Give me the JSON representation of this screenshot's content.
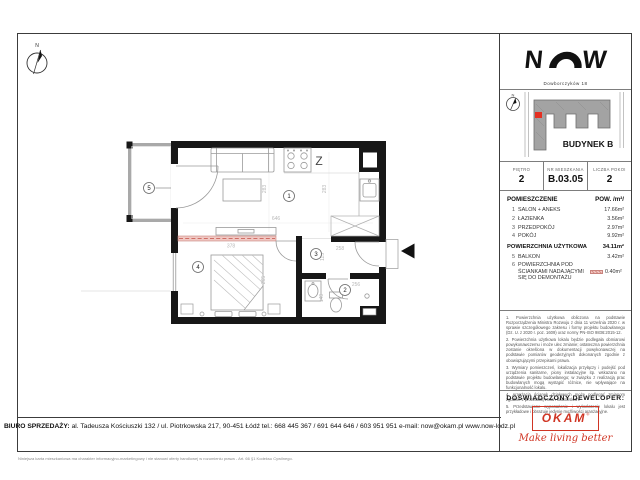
{
  "logo": {
    "letter_n": "N",
    "letter_w": "W",
    "subtitle": "Dowborczyków 18"
  },
  "sitemap": {
    "compass_n": "N",
    "building_label": "BUDYNEK B"
  },
  "unit_info": {
    "columns": [
      {
        "label": "PIĘTRO",
        "value": "2"
      },
      {
        "label": "NR MIESZKANIA",
        "value": "B.03.05"
      },
      {
        "label": "LICZBA POKOI",
        "value": "2"
      }
    ]
  },
  "rooms": {
    "header_name": "POMIESZCZENIE",
    "header_area": "POW. /m²/",
    "items": [
      {
        "no": "1",
        "name": "SALON + ANEKS",
        "area": "17.66m²"
      },
      {
        "no": "2",
        "name": "ŁAZIENKA",
        "area": "3.56m²"
      },
      {
        "no": "3",
        "name": "PRZEDPOKÓJ",
        "area": "2.97m²"
      },
      {
        "no": "4",
        "name": "POKÓJ",
        "area": "9.92m²"
      }
    ],
    "total_label": "POWIERZCHNIA UŻYTKOWA",
    "total_area": "34.11m²",
    "extras": [
      {
        "no": "5",
        "name": "BALKON",
        "area": "3.42m²"
      },
      {
        "no": "6",
        "name": "POWIERZCHNIA POD ŚCIANKAMI NADAJĄCYMI SIĘ DO DEMONTAŻU",
        "area": "0.40m²"
      }
    ]
  },
  "legal": {
    "paragraphs": [
      "1. Powierzchnia użytkowa obliczona na podstawie Rozporządzenia Ministra Rozwoju z dnia 11 września 2020 r. w sprawie szczegółowego zakresu i formy projektu budowlanego (Dz. U. z 2020 r. poz. 1609) oraz normy PN-ISO 9836:2015-12.",
      "2. Powierzchnia użytkowa lokalu będzie podlegała obmiarowi powykonawczemu i może ulec zmianie; ostateczna powierzchnia zostanie określona w dokumentacji powykonawczej na podstawie pomiarów geodezyjnych dokonanych zgodnie z obowiązującymi przepisami prawa.",
      "3. Wymiary pomieszczeń, lokalizacja przyłączy i podejść pod urządzenia sanitarne, piony instalacyjne itp. wskazano na podstawie projektu budowlanego; w związku z realizacją prac budowlanych mogą wystąpić różnice, nie wpływające na funkcjonalność lokalu.",
      "4. Aranżacja ścianek działowych może podlegać zmianom zgodnie z procedurą zmian lokatorskich.",
      "5. Przedstawione wyposażenie i wykończenie lokalu jest przykładowe i obrazuje jedynie możliwości aranżacyjne."
    ]
  },
  "developer": {
    "heading": "DOŚWIADCZONY DEWELOPER:",
    "logo_text": "OKAM",
    "logo_reg": "®",
    "tagline": "Make living better"
  },
  "footer": {
    "sales_label": "BIURO SPRZEDAŻY:",
    "sales_info": "al. Tadeusza Kościuszki 132 / ul. Piotrkowska 217, 90-451 Łódź tel.: 668 445 367 / 691 644 646 / 603 951 951 e-mail: now@okam.pl www.now-lodz.pl",
    "disclaimer": "Niniejsza karta mieszkaniowa ma charakter informacyjno-marketingowy i nie stanowi oferty handlowej w rozumieniu prawa - Art. 66 §1 Kodeksu Cywilnego."
  },
  "plan": {
    "compass_n": "N",
    "kitchen_label": "Z",
    "badges": [
      "1",
      "2",
      "3",
      "4",
      "5"
    ],
    "dims": {
      "living_width": "646",
      "living_depth_left": "283",
      "living_depth_right": "283",
      "bedroom_width": "378",
      "bedroom_depth": "265",
      "hall_width": "258",
      "hall_height": "115",
      "bath_width": "256",
      "bath_depth": "149"
    }
  }
}
